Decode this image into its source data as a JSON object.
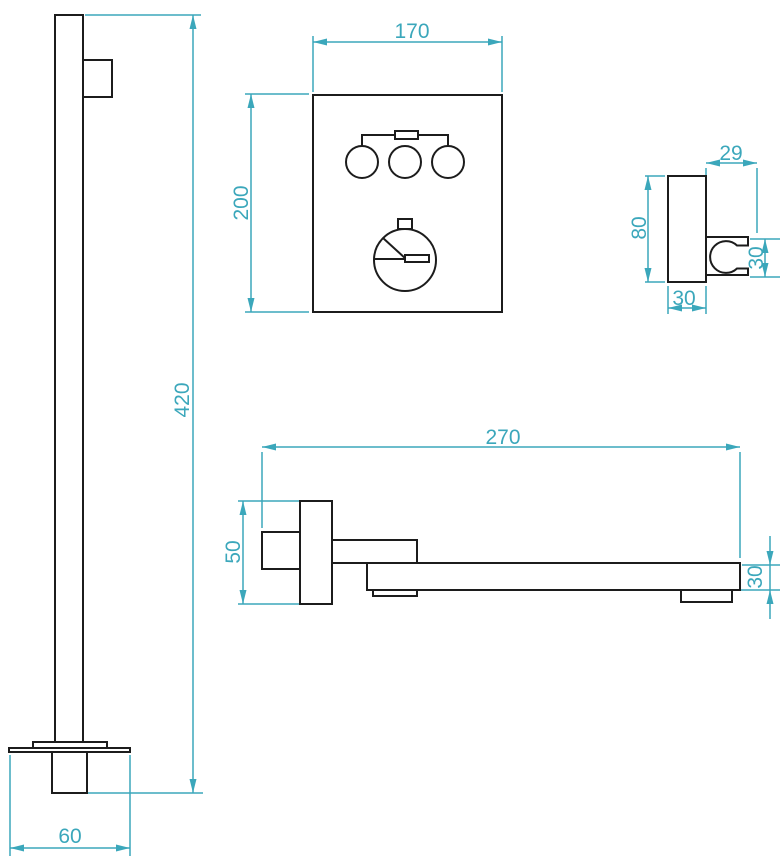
{
  "colors": {
    "dimension": "#3BA7BB",
    "outline": "#1C1C1C",
    "background": "#FFFFFF"
  },
  "views": {
    "shower_rail": {
      "height": "420",
      "base_width": "60"
    },
    "mixer_panel": {
      "width": "170",
      "height": "200"
    },
    "shower_holder": {
      "bracket_width": "29",
      "body_height": "80",
      "clip_height": "30",
      "body_width": "30"
    },
    "wall_spout": {
      "length": "270",
      "flange_height": "50",
      "spout_height": "30"
    }
  }
}
